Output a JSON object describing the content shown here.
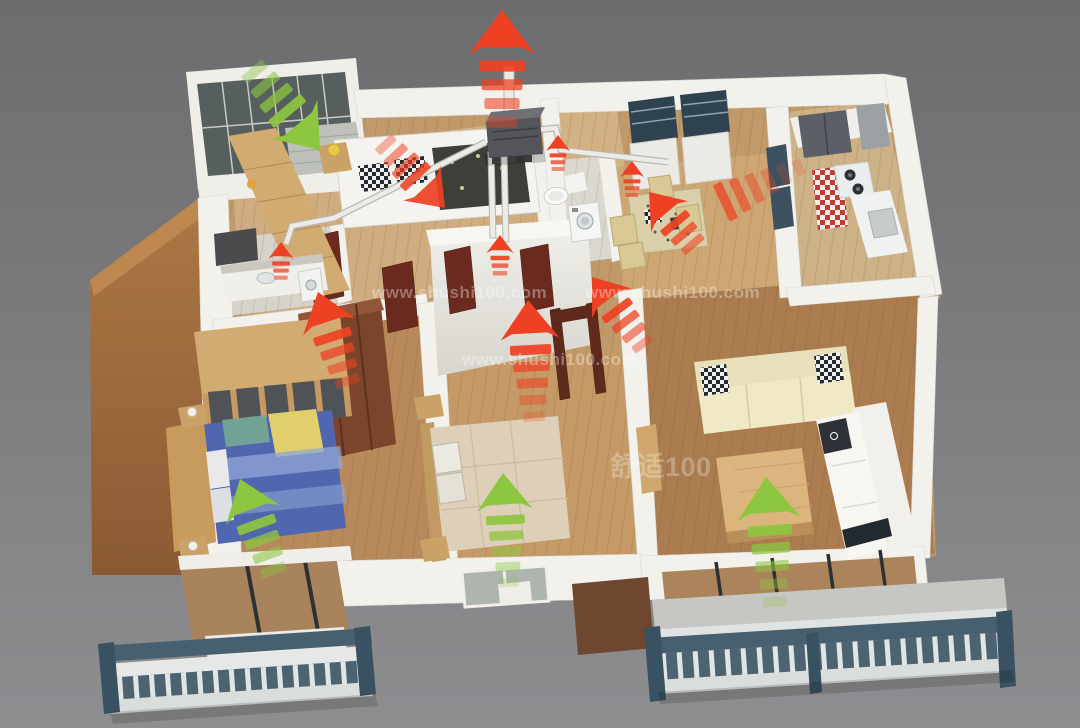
{
  "scene": {
    "description": "3D cutaway floor plan of an apartment with a fresh-air ventilation system diagram",
    "exhaust_color_meaning": "red-arrows",
    "supply_color_meaning": "green-arrows"
  },
  "palette": {
    "background_top": "#6c6c6e",
    "background_bottom": "#8e8e91",
    "exhaust_red": "#ee4123",
    "fresh_green": "#8dc63f",
    "wall_white": "#f2f1ec",
    "floor_wood": "#c09a6a",
    "left_wall_brown": "#a06a3e",
    "railing_blue_gray": "#4d6372",
    "duct_white": "#ecebe5",
    "unit_gray": "#54555a",
    "door_mahogany": "#6b2a1e"
  },
  "watermarks": {
    "text": "www.shushi100.com",
    "logo_text": "舒适100",
    "instances": [
      {
        "x": 372,
        "y": 298,
        "size": 17,
        "opacity": 0.34
      },
      {
        "x": 585,
        "y": 298,
        "size": 17,
        "opacity": 0.34
      },
      {
        "x": 462,
        "y": 365,
        "size": 17,
        "opacity": 0.34
      },
      {
        "x": 610,
        "y": 476,
        "size": 27,
        "opacity": 0.28,
        "logo": true
      }
    ]
  },
  "airflows": [
    {
      "id": "roof-exhaust-main",
      "color": "red",
      "x": 502,
      "y": 10,
      "angle": 0,
      "scale": 1.1,
      "dashes": 4
    },
    {
      "id": "bedroom1-exhaust",
      "color": "red",
      "x": 445,
      "y": 208,
      "angle": 137,
      "scale": 0.85,
      "dashes": 4,
      "opacity": 0.92
    },
    {
      "id": "hall-wardrobe-exhaust",
      "color": "red",
      "x": 318,
      "y": 292,
      "angle": -18,
      "scale": 0.92,
      "dashes": 4
    },
    {
      "id": "hall-center-exhaust",
      "color": "red",
      "x": 528,
      "y": 300,
      "angle": -3,
      "scale": 0.98,
      "dashes": 5
    },
    {
      "id": "living-to-hall-exhaust",
      "color": "red",
      "x": 592,
      "y": 277,
      "angle": -37,
      "scale": 0.82,
      "dashes": 4
    },
    {
      "id": "dining-exhaust",
      "color": "red",
      "x": 649,
      "y": 192,
      "angle": -40,
      "scale": 0.8,
      "dashes": 3
    },
    {
      "id": "kitchen-exhaust-trail",
      "color": "red",
      "x": 716,
      "y": 206,
      "angle": -115,
      "scale": 0.95,
      "dashes": 6,
      "head": false,
      "opacity": 0.8
    },
    {
      "id": "grille-bathroom-left",
      "color": "red",
      "x": 281,
      "y": 242,
      "angle": 0,
      "scale": 0.42,
      "dashes": 3
    },
    {
      "id": "grille-bathroom-center",
      "color": "red",
      "x": 558,
      "y": 135,
      "angle": 0,
      "scale": 0.4,
      "dashes": 3
    },
    {
      "id": "grille-dining",
      "color": "red",
      "x": 632,
      "y": 161,
      "angle": 0,
      "scale": 0.4,
      "dashes": 3
    },
    {
      "id": "grille-hallway",
      "color": "red",
      "x": 500,
      "y": 235,
      "angle": 0,
      "scale": 0.45,
      "dashes": 3
    },
    {
      "id": "fresh-air-inlet-balcony",
      "color": "green",
      "x": 320,
      "y": 150,
      "angle": 140,
      "scale": 1.0,
      "dashes": 4
    },
    {
      "id": "fresh-master-bedroom",
      "color": "green",
      "x": 240,
      "y": 479,
      "angle": -20,
      "scale": 0.95,
      "dashes": 4
    },
    {
      "id": "fresh-bedroom2",
      "color": "green",
      "x": 503,
      "y": 473,
      "angle": -3,
      "scale": 0.92,
      "dashes": 5
    },
    {
      "id": "fresh-living-room",
      "color": "green",
      "x": 766,
      "y": 477,
      "angle": -4,
      "scale": 1.05,
      "dashes": 5
    }
  ]
}
